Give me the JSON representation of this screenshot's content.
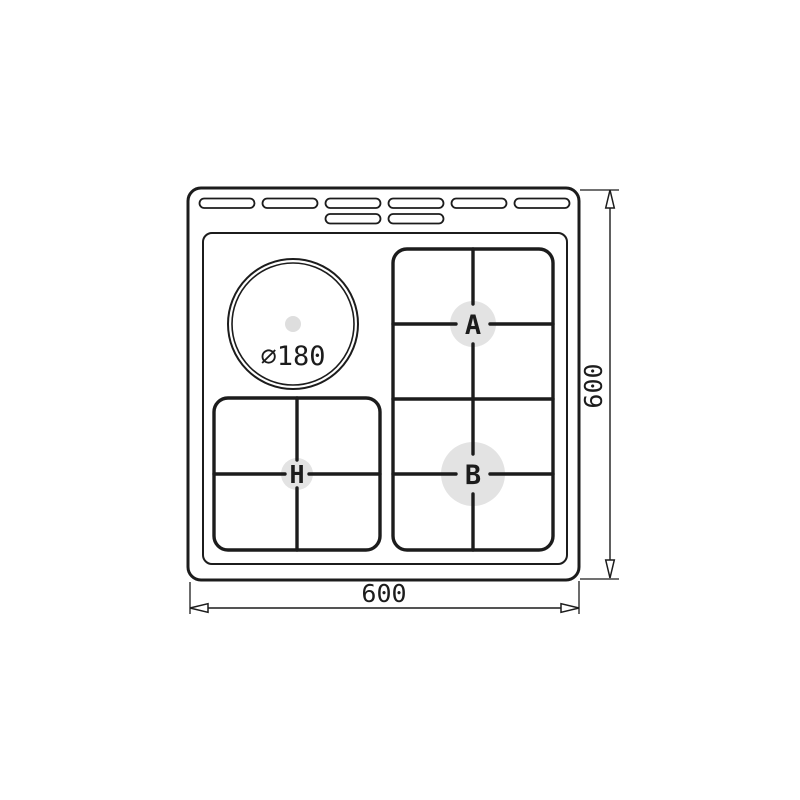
{
  "diagram": {
    "labels": {
      "width_dimension": "600",
      "height_dimension": "600",
      "hotplate_diameter": "⌀180",
      "burner_a": "A",
      "burner_b": "B",
      "burner_h": "H"
    },
    "colors": {
      "line": "#1c1c1c",
      "burner_highlight": "#e3e3e3",
      "hotplate_dot": "#dedede",
      "background": "#ffffff"
    },
    "vents": {
      "top_row_count": 6,
      "second_row_count": 2
    }
  }
}
